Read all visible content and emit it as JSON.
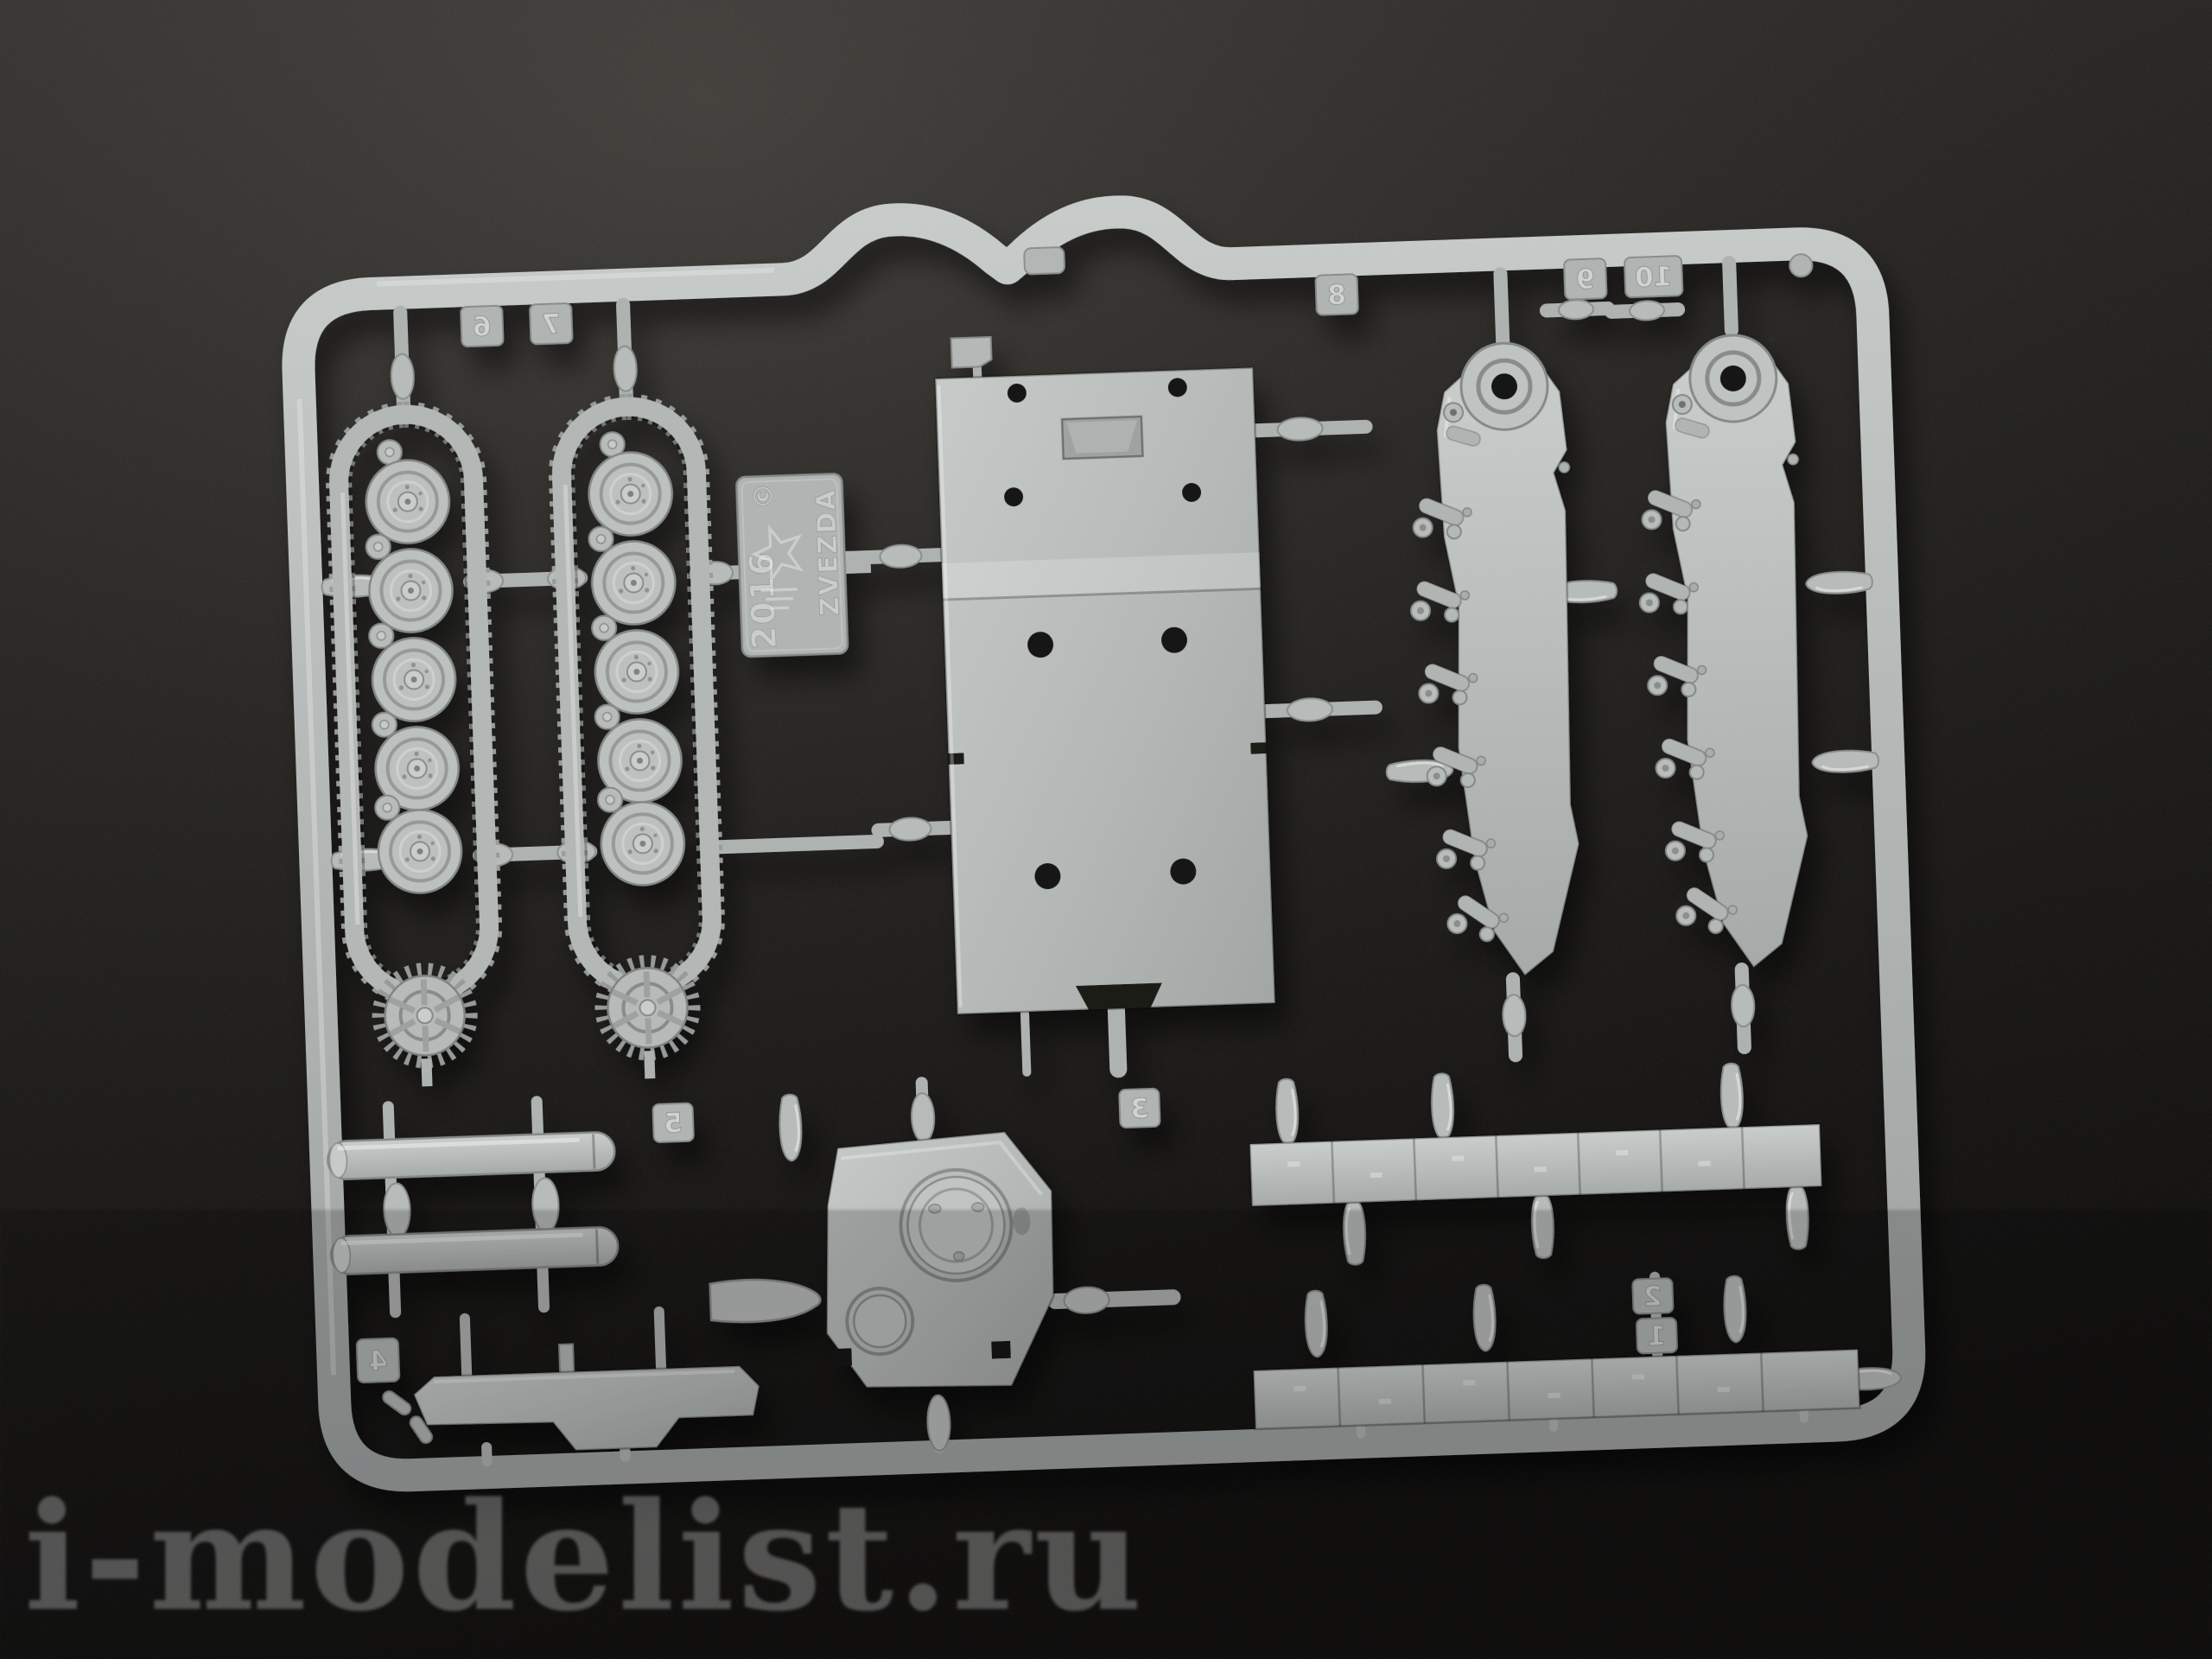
{
  "scene": {
    "type": "photograph",
    "subject": "grey injection-molded plastic model kit sprue on a dark textured mat",
    "background_color": "#1c1b19",
    "plastic_color": "#b5b9b7"
  },
  "sprue": {
    "brand_tag": {
      "year": "2016",
      "brand": "ZVEZDA",
      "copyright_symbol": "©",
      "logo": "zvezda-star-logo"
    },
    "part_number_tags": [
      "6",
      "7",
      "8",
      "9",
      "10",
      "5",
      "4",
      "3",
      "2",
      "1"
    ],
    "parts": [
      {
        "name": "track-assembly-left"
      },
      {
        "name": "track-assembly-right"
      },
      {
        "name": "upper-hull-plate"
      },
      {
        "name": "suspension-side-panel-left"
      },
      {
        "name": "suspension-side-panel-right"
      },
      {
        "name": "gun-barrel-upper"
      },
      {
        "name": "gun-barrel-lower"
      },
      {
        "name": "hull-bottom-brace"
      },
      {
        "name": "turret-top"
      },
      {
        "name": "fender-strip-upper"
      },
      {
        "name": "fender-strip-lower"
      }
    ]
  },
  "watermark": {
    "text": "i-modelist.ru"
  }
}
